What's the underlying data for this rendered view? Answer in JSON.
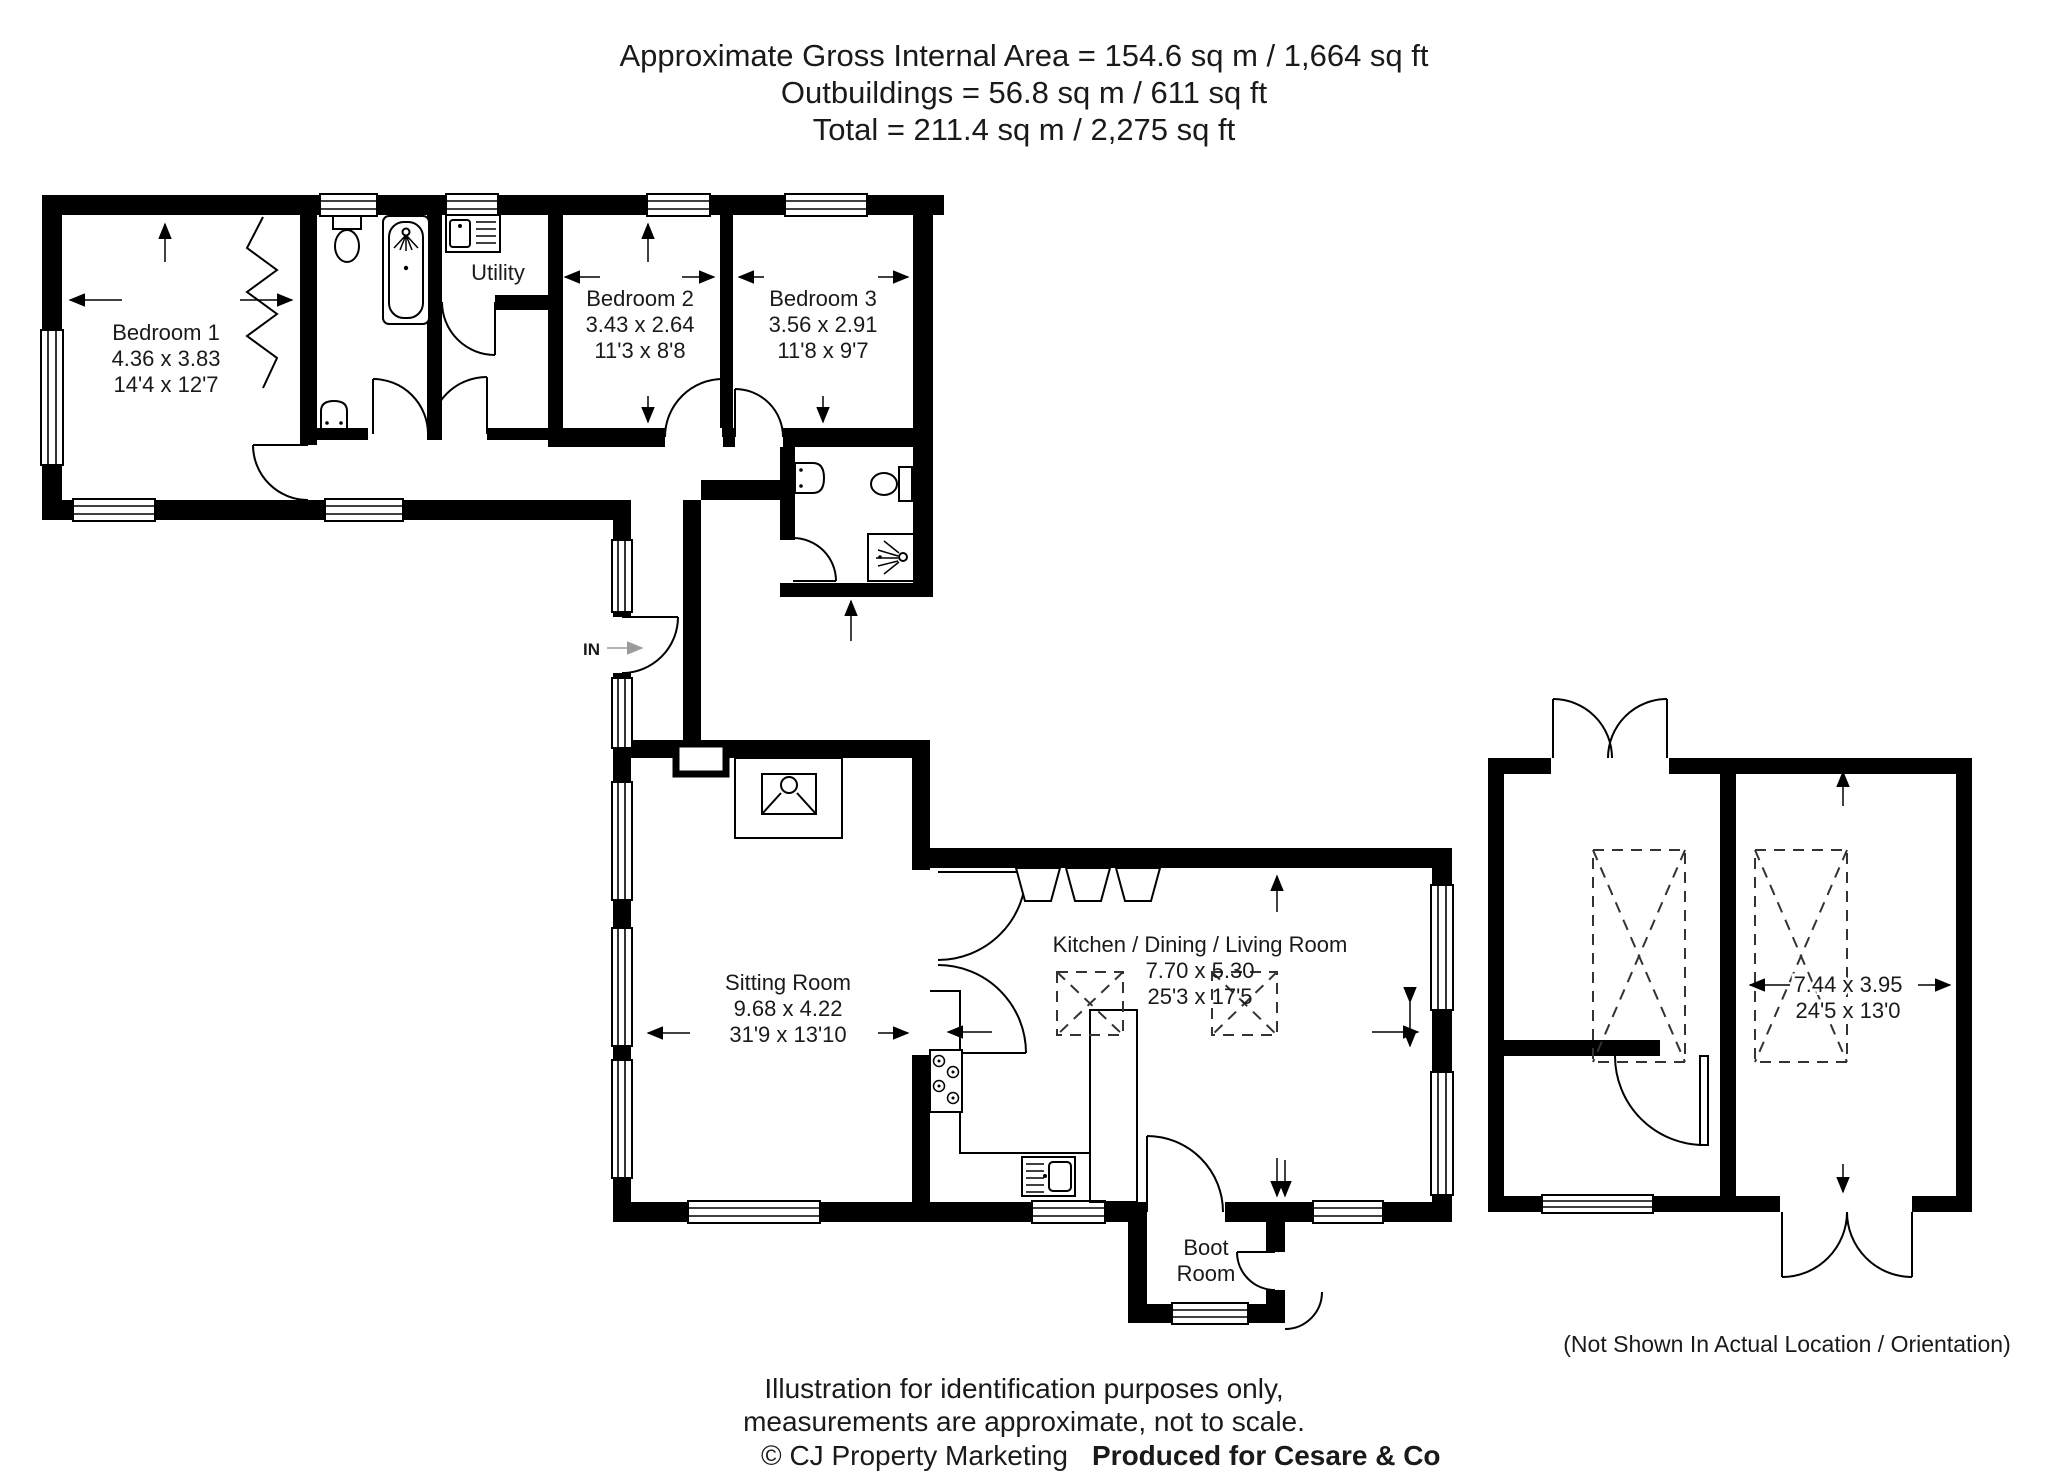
{
  "title": {
    "line1": "Approximate Gross Internal Area = 154.6 sq m / 1,664 sq ft",
    "line2": "Outbuildings = 56.8 sq m / 611 sq ft",
    "line3": "Total = 211.4 sq m / 2,275 sq ft"
  },
  "rooms": {
    "bedroom1": {
      "name": "Bedroom 1",
      "metric": "4.36 x 3.83",
      "imperial": "14'4 x 12'7"
    },
    "bedroom2": {
      "name": "Bedroom 2",
      "metric": "3.43 x 2.64",
      "imperial": "11'3 x 8'8"
    },
    "bedroom3": {
      "name": "Bedroom 3",
      "metric": "3.56 x 2.91",
      "imperial": "11'8 x 9'7"
    },
    "utility": {
      "name": "Utility"
    },
    "sitting_room": {
      "name": "Sitting Room",
      "metric": "9.68 x 4.22",
      "imperial": "31'9 x 13'10"
    },
    "kitchen_dining_living": {
      "name": "Kitchen / Dining / Living Room",
      "metric": "7.70 x 5.30",
      "imperial": "25'3 x 17'5"
    },
    "boot_room": {
      "line1": "Boot",
      "line2": "Room"
    },
    "outbuilding": {
      "metric": "7.44 x 3.95",
      "imperial": "24'5 x 13'0"
    },
    "entrance": {
      "label": "IN"
    }
  },
  "notes": {
    "outbuilding_location": "(Not Shown In Actual Location / Orientation)"
  },
  "footer": {
    "line1": "Illustration for identification purposes only,",
    "line2": "measurements are approximate, not to scale.",
    "credit": "© CJ Property Marketing",
    "produced_for": "Produced for Cesare & Co"
  },
  "colors": {
    "wall": "#000000",
    "text": "#1a1a1a",
    "credit_teal": "#45c0a8",
    "background": "#ffffff"
  }
}
